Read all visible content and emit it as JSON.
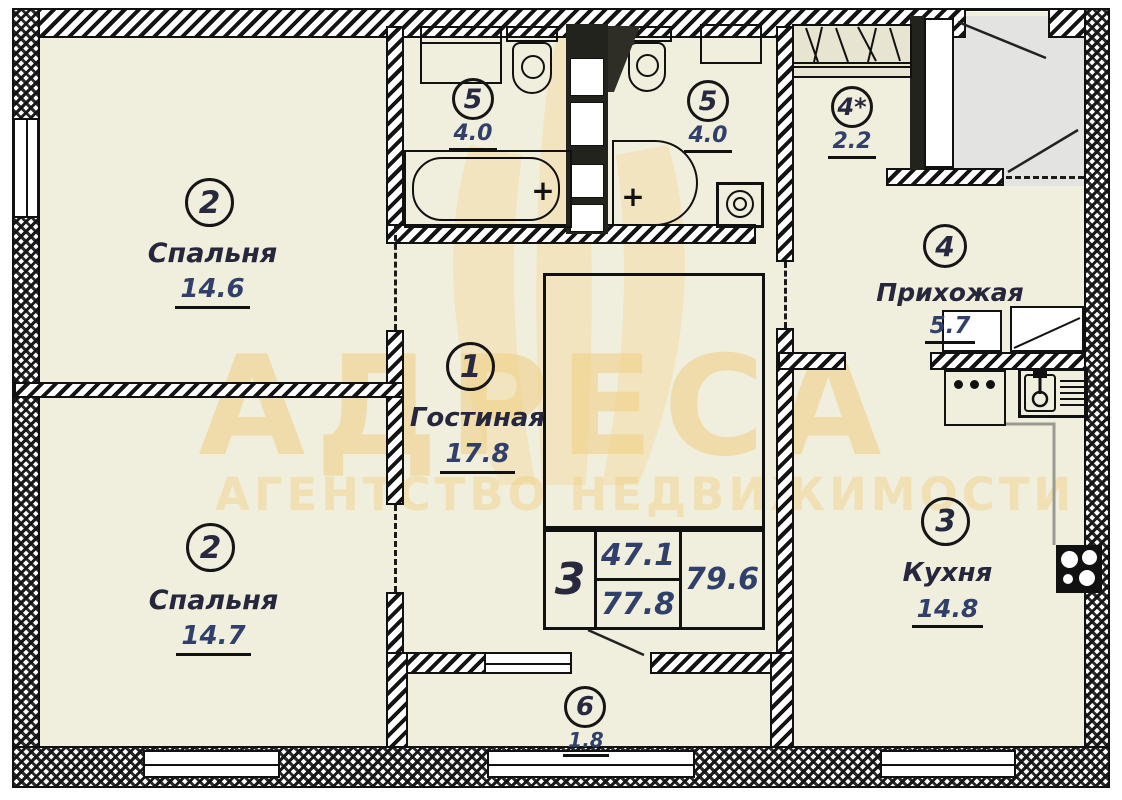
{
  "watermark": {
    "title": "АДРЕСА",
    "subtitle": "АГЕНТСТВО НЕДВИЖИМОСТИ"
  },
  "rooms": [
    {
      "id": "bedroom-top",
      "number": "2",
      "name": "Спальня",
      "area": "14.6"
    },
    {
      "id": "bedroom-bottom",
      "number": "2",
      "name": "Спальня",
      "area": "14.7"
    },
    {
      "id": "living-room",
      "number": "1",
      "name": "Гостиная",
      "area": "17.8"
    },
    {
      "id": "bathroom-left",
      "number": "5",
      "name": "",
      "area": "4.0"
    },
    {
      "id": "bathroom-right",
      "number": "5",
      "name": "",
      "area": "4.0"
    },
    {
      "id": "closet",
      "number": "4*",
      "name": "",
      "area": "2.2"
    },
    {
      "id": "hallway",
      "number": "4",
      "name": "Прихожая",
      "area": "5.7"
    },
    {
      "id": "kitchen",
      "number": "3",
      "name": "Кухня",
      "area": "14.8"
    },
    {
      "id": "balcony",
      "number": "6",
      "name": "",
      "area": "1.8"
    }
  ],
  "stamp": {
    "room_count": "3",
    "living_area": "47.1",
    "apartment_area": "77.8",
    "total_area": "79.6"
  },
  "symbols": {
    "plus": "+"
  },
  "colors": {
    "room_fill": "#f0eedd",
    "entry_fill": "#e3e3e1",
    "watermark": "#f0ce80",
    "line": "#111111"
  }
}
